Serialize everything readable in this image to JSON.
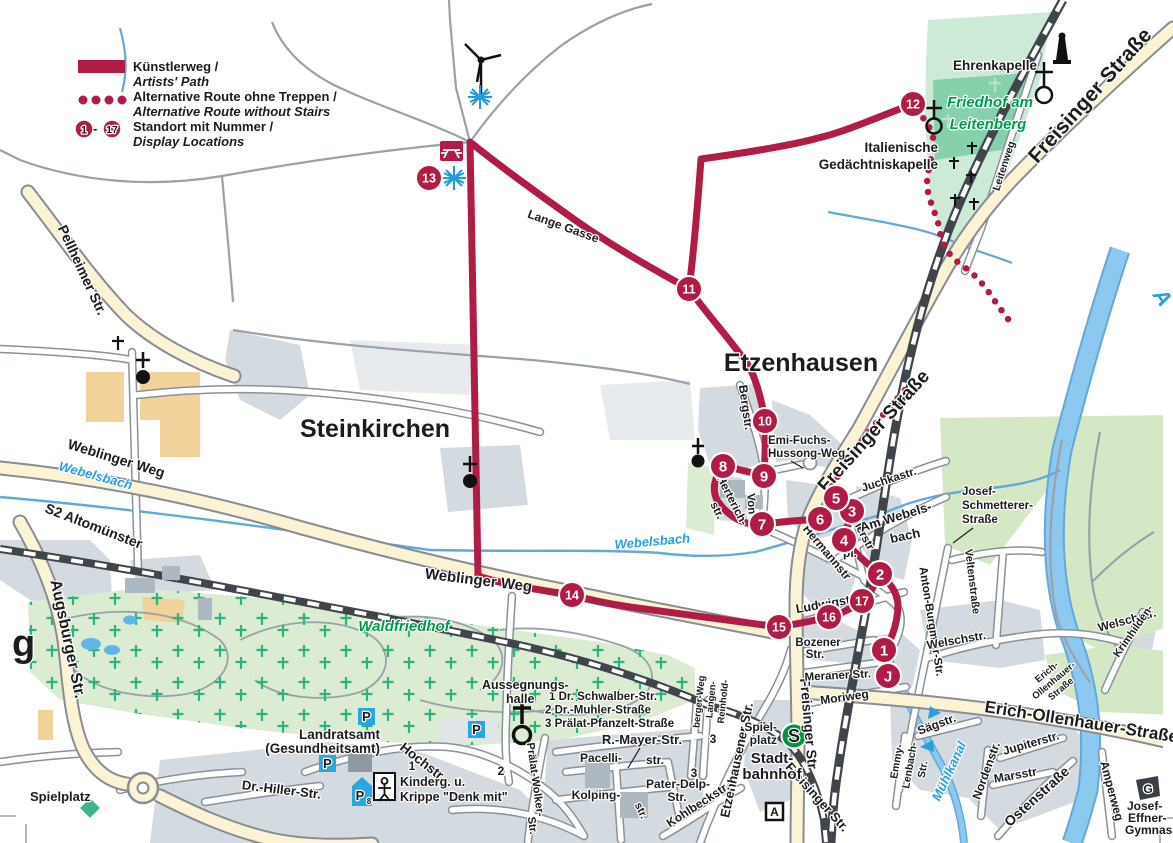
{
  "legend": {
    "kuenstlerweg": "Künstlerweg /",
    "artists_path": "Artists' Path",
    "alt_route_de": "Alternative Route ohne Treppen /",
    "alt_route_en": "Alternative Route without Stairs",
    "standort_de": "Standort mit Nummer /",
    "standort_en": "Display Locations",
    "badge_start": "1",
    "badge_dash": "-",
    "badge_end": "17"
  },
  "places": {
    "steinkirchen": "Steinkirchen",
    "etzenhausen": "Etzenhausen",
    "waldfriedhof": "Waldfriedhof",
    "friedhof1": "Friedhof am",
    "friedhof2": "Leitenberg",
    "ehrenkapelle": "Ehrenkapelle",
    "ital1": "Italienische",
    "ital2": "Gedächtniskapelle",
    "aussegnungs1": "Aussegnungs-",
    "aussegnungs2": "halle",
    "landratsamt1": "Landratsamt",
    "landratsamt2": "(Gesundheitsamt)",
    "kinderg1": "Kinderg. u.",
    "kinderg2": "Krippe \"Denk mit\"",
    "spielplatz_sw": "Spielplatz",
    "spielplatz_s1": "Spiel-",
    "spielplatz_s2": "platz",
    "stadtbahnhof1": "Stadt-",
    "stadtbahnhof2": "bahnhof",
    "s2_line": "S2 Altomünster",
    "josef_effner1": "Josef-",
    "josef_effner2": "Effner-",
    "josef_effner3": "Gymnasium"
  },
  "waters": {
    "webelsbach1": "Webelsbach",
    "webelsbach2": "Webelsbach",
    "muehlkanal": "Mühlkanal",
    "amper": "A"
  },
  "streets": {
    "freisinger_ne": "Freisinger Straße",
    "freisinger_mid": "Freisinger Straße",
    "freisinger_s": "Freisinger Str",
    "freisinger_s2": "Freisinger Str.",
    "pellheimer": "Pellheimer Str.",
    "weblinger1": "Weblinger Weg",
    "weblinger2": "Weblinger Weg",
    "augsburger": "Augsburger Str.",
    "lange_gasse": "Lange Gasse",
    "bergstr": "Bergstr.",
    "emi1": "Emi-Fuchs-",
    "emi2": "Hussong-Weg",
    "herterich": "Herterich-",
    "herterich_str": "str.",
    "von": "Von-",
    "hermannstr": "Hermannstr",
    "ludwigstr": "Ludwigstr",
    "ustlerstr": "Ustlerstr",
    "pl": "pl.",
    "am_webels": "Am Webels-",
    "bach": "bach",
    "juchkastr": "Juchkastr.",
    "josef_schm1": "Josef-",
    "josef_schm2": "Schmetterer-",
    "josef_schm3": "Straße",
    "veltenstr": "Veltenstraße",
    "anton": "Anton-Burgmair-Str.",
    "welschstr": "Welschstr.",
    "welschstr2": "Welschstr.",
    "erich_big": "Erich-Ollenhauer-Straße",
    "erich1": "Erich-",
    "er2": "Ollenhauer-",
    "er3": "Straße",
    "jupiter": "Jupiterstr.",
    "norden": "Nordenstr.",
    "mars": "Marsstr",
    "osten": "Ostenstraße",
    "amperweg": "Amperweg",
    "saegstr": "Sägstr.",
    "emmy1": "Emmy-",
    "emmy2": "Lenbach-",
    "emmy3": "Str.",
    "krimhilden": "Krimhilden-",
    "leitenweg": "Leitenweg",
    "etzenhausener": "Etzenhausener Str.",
    "bozener1": "Bozener",
    "bozener2": "Str.",
    "meraner": "Meraner Str.",
    "moriweg": "Moriweg",
    "hochstr": "Hochstr.",
    "dr_hiller": "Dr.-Hiller-Str.",
    "praelat_wolker1": "Prälat-Wolker-",
    "praelat_wolker2": "Str.",
    "r_mayer": "R.-Mayer-Str.",
    "pacelli1": "Pacelli-",
    "pacelli2": "str.",
    "kolping1": "Kolping-",
    "kolping2": "str.",
    "pater_delp1": "Pater-Delp-",
    "pater_delp2": "Str.",
    "kohlbeck": "Kohlbeckstr.",
    "reinhold": "Reinhold-",
    "langen": "Langen-",
    "bergerweg": "berger-Weg"
  },
  "street_key": {
    "k1": "1 Dr. Schwalber-Str.",
    "k2": "2 Dr.-Muhler-Straße",
    "k3": "3 Prälat-Pfanzelt-Straße"
  },
  "refs": {
    "r1": "1",
    "r2": "2",
    "r3": "3",
    "r4": "3"
  },
  "markers": {
    "m1": "1",
    "m2": "2",
    "m3": "3",
    "m4": "4",
    "m5": "5",
    "m6": "6",
    "m7": "7",
    "m8": "8",
    "m9": "9",
    "m10": "10",
    "m11": "11",
    "m12": "12",
    "m13": "13",
    "m14": "14",
    "m15": "15",
    "m16": "16",
    "m17": "17",
    "mj": "J"
  },
  "icons": {
    "s_bahn": "S",
    "parking": "P",
    "parking8": "8",
    "autobahn": "A",
    "gymnasium_g": "G"
  },
  "partial": {
    "g": "g"
  },
  "colors": {
    "route": "#b01c46",
    "green_text": "#009a4e",
    "water_text": "#2a9fd8",
    "sbahn_green": "#00963f",
    "parking_blue": "#29a8e0",
    "major_road": "#fbf3d3",
    "builtup": "#d3dae0",
    "cemetery_green": "#dcecd2"
  }
}
